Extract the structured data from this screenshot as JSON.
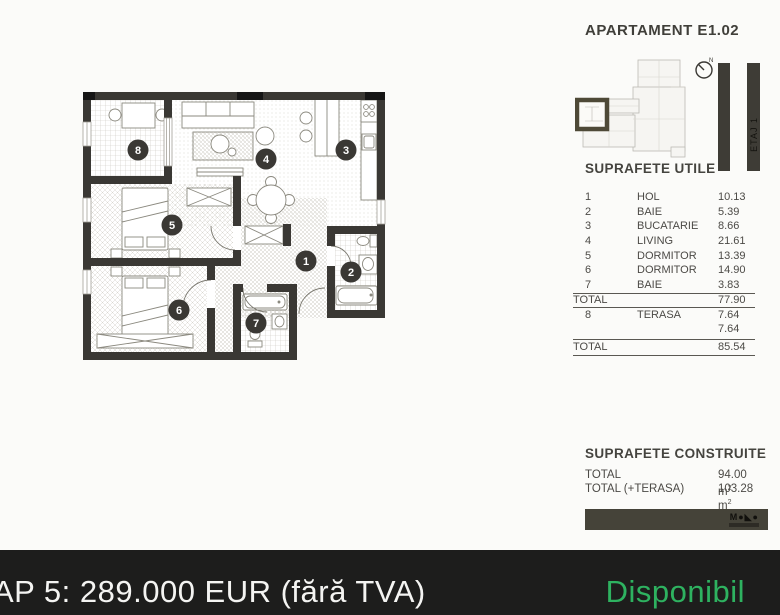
{
  "header": {
    "title": "APARTAMENT E1.02"
  },
  "keyplan": {
    "compass": "N",
    "floor": "ETAJ 1"
  },
  "suprafete_utile": {
    "title": "SUPRAFETE UTILE",
    "rows": [
      {
        "num": "1",
        "name": "HOL",
        "value": "10.13"
      },
      {
        "num": "2",
        "name": "BAIE",
        "value": "5.39"
      },
      {
        "num": "3",
        "name": "BUCATARIE",
        "value": "8.66"
      },
      {
        "num": "4",
        "name": "LIVING",
        "value": "21.61"
      },
      {
        "num": "5",
        "name": "DORMITOR",
        "value": "13.39"
      },
      {
        "num": "6",
        "name": "DORMITOR",
        "value": "14.90"
      },
      {
        "num": "7",
        "name": "BAIE",
        "value": "3.83"
      }
    ],
    "total": {
      "label": "TOTAL",
      "value": "77.90"
    },
    "terasa_rows": [
      {
        "num": "8",
        "name": "TERASA",
        "value": "7.64"
      },
      {
        "num": "",
        "name": "",
        "value": "7.64"
      }
    ],
    "total_with_terasa": {
      "label": "TOTAL",
      "value": "85.54"
    }
  },
  "suprafete_construite": {
    "title": "SUPRAFETE CONSTRUITE",
    "rows": [
      {
        "label": "TOTAL",
        "value": "94.00 m",
        "sup": "2"
      },
      {
        "label": "TOTAL (+TERASA)",
        "value": "103.28 m",
        "sup": "2"
      }
    ]
  },
  "floorplan": {
    "rooms": [
      "1",
      "2",
      "3",
      "4",
      "5",
      "6",
      "7",
      "8"
    ]
  },
  "logo": {
    "glyphs": "M●◣●"
  },
  "footer": {
    "price": "AP 5: 289.000 EUR (fără TVA)",
    "status": "Disponibil"
  },
  "colors": {
    "status_green": "#2eb260",
    "wall": "#3a3834",
    "footer_bar": "#1d1d1c",
    "accent_keyplan": "#4e4937"
  }
}
